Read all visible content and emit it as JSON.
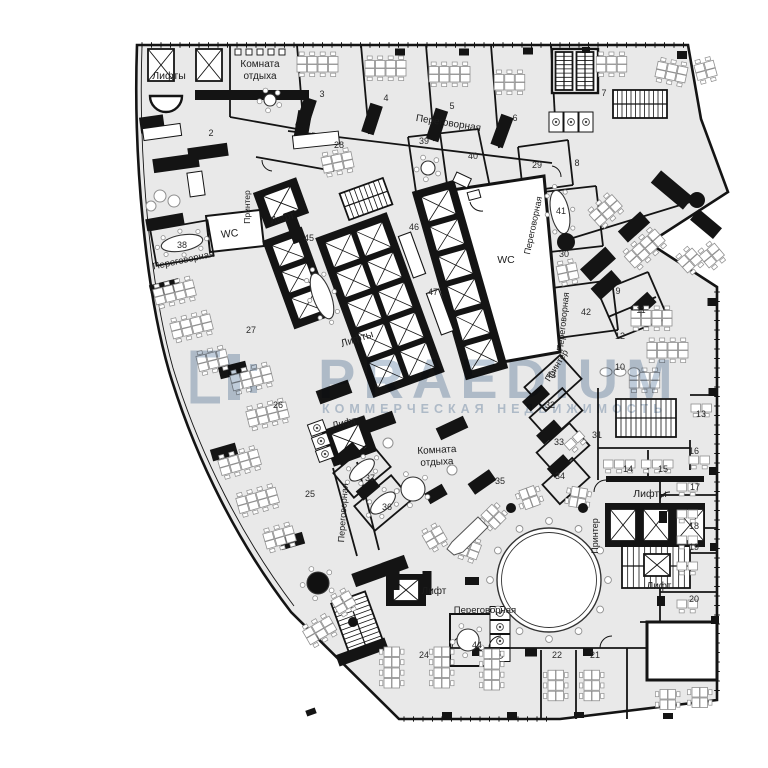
{
  "plan": {
    "labels": [
      {
        "text": "Лифты",
        "x": 169,
        "y": 79,
        "rot": 0,
        "size": 10.5
      },
      {
        "text": "Комната",
        "x": 260,
        "y": 67,
        "rot": 0,
        "size": 10
      },
      {
        "text": "отдыха",
        "x": 260,
        "y": 79,
        "rot": 0,
        "size": 10
      },
      {
        "text": "Переговорная",
        "x": 448,
        "y": 126,
        "rot": 9,
        "size": 10
      },
      {
        "text": "Принтер",
        "x": 250,
        "y": 207,
        "rot": -90,
        "size": 8.5
      },
      {
        "text": "Лифт",
        "x": 283,
        "y": 221,
        "rot": -14,
        "size": 10
      },
      {
        "text": "WC",
        "x": 230,
        "y": 237,
        "rot": -6,
        "size": 10.5
      },
      {
        "text": "Переговорная",
        "x": 184,
        "y": 263,
        "rot": -12,
        "size": 9.5
      },
      {
        "text": "Лифты",
        "x": 358,
        "y": 342,
        "rot": -18,
        "size": 10.5
      },
      {
        "text": "WC",
        "x": 506,
        "y": 263,
        "rot": 0,
        "size": 10.5
      },
      {
        "text": "Переговорная",
        "x": 536,
        "y": 226,
        "rot": -78,
        "size": 9
      },
      {
        "text": "Переговорная",
        "x": 566,
        "y": 322,
        "rot": -84,
        "size": 9
      },
      {
        "text": "Принтер",
        "x": 559,
        "y": 367,
        "rot": -58,
        "size": 9
      },
      {
        "text": "Лифт",
        "x": 345,
        "y": 426,
        "rot": -14,
        "size": 10
      },
      {
        "text": "Комната",
        "x": 437,
        "y": 453,
        "rot": -3,
        "size": 10
      },
      {
        "text": "отдыха",
        "x": 437,
        "y": 465,
        "rot": -3,
        "size": 10
      },
      {
        "text": "Переговорная",
        "x": 346,
        "y": 513,
        "rot": -86,
        "size": 9
      },
      {
        "text": "Принтер",
        "x": 598,
        "y": 536,
        "rot": -90,
        "size": 9
      },
      {
        "text": "Лифты",
        "x": 650,
        "y": 497,
        "rot": 0,
        "size": 10.5
      },
      {
        "text": "Лифт",
        "x": 659,
        "y": 589,
        "rot": 0,
        "size": 10
      },
      {
        "text": "Лифт",
        "x": 434,
        "y": 594,
        "rot": 0,
        "size": 10
      },
      {
        "text": "Переговорная",
        "x": 485,
        "y": 613,
        "rot": 0,
        "size": 9.5
      }
    ],
    "room_numbers": [
      {
        "n": "2",
        "x": 211,
        "y": 136
      },
      {
        "n": "3",
        "x": 322,
        "y": 97
      },
      {
        "n": "4",
        "x": 386,
        "y": 101
      },
      {
        "n": "5",
        "x": 452,
        "y": 109
      },
      {
        "n": "6",
        "x": 515,
        "y": 121
      },
      {
        "n": "7",
        "x": 604,
        "y": 96
      },
      {
        "n": "8",
        "x": 577,
        "y": 166
      },
      {
        "n": "9",
        "x": 618,
        "y": 294
      },
      {
        "n": "10",
        "x": 620,
        "y": 370
      },
      {
        "n": "11",
        "x": 641,
        "y": 313
      },
      {
        "n": "12",
        "x": 620,
        "y": 339
      },
      {
        "n": "13",
        "x": 701,
        "y": 417
      },
      {
        "n": "14",
        "x": 628,
        "y": 472
      },
      {
        "n": "15",
        "x": 663,
        "y": 472
      },
      {
        "n": "16",
        "x": 694,
        "y": 454
      },
      {
        "n": "17",
        "x": 695,
        "y": 490
      },
      {
        "n": "18",
        "x": 694,
        "y": 529
      },
      {
        "n": "19",
        "x": 694,
        "y": 550
      },
      {
        "n": "20",
        "x": 694,
        "y": 602
      },
      {
        "n": "21",
        "x": 595,
        "y": 658
      },
      {
        "n": "22",
        "x": 557,
        "y": 658
      },
      {
        "n": "24",
        "x": 424,
        "y": 658
      },
      {
        "n": "25",
        "x": 310,
        "y": 497
      },
      {
        "n": "26",
        "x": 278,
        "y": 408
      },
      {
        "n": "27",
        "x": 251,
        "y": 333
      },
      {
        "n": "28",
        "x": 339,
        "y": 148
      },
      {
        "n": "29",
        "x": 537,
        "y": 168
      },
      {
        "n": "30",
        "x": 564,
        "y": 257
      },
      {
        "n": "31",
        "x": 597,
        "y": 438
      },
      {
        "n": "32",
        "x": 550,
        "y": 408
      },
      {
        "n": "33",
        "x": 559,
        "y": 445
      },
      {
        "n": "34",
        "x": 560,
        "y": 479
      },
      {
        "n": "35",
        "x": 500,
        "y": 484
      },
      {
        "n": "36",
        "x": 387,
        "y": 510
      },
      {
        "n": "37",
        "x": 370,
        "y": 481
      },
      {
        "n": "38",
        "x": 182,
        "y": 248
      },
      {
        "n": "39",
        "x": 424,
        "y": 144
      },
      {
        "n": "40",
        "x": 473,
        "y": 159
      },
      {
        "n": "41",
        "x": 561,
        "y": 214
      },
      {
        "n": "42",
        "x": 586,
        "y": 315
      },
      {
        "n": "43",
        "x": 551,
        "y": 378
      },
      {
        "n": "44",
        "x": 477,
        "y": 648
      },
      {
        "n": "45",
        "x": 309,
        "y": 241
      },
      {
        "n": "46",
        "x": 414,
        "y": 230
      },
      {
        "n": "47",
        "x": 433,
        "y": 295
      }
    ]
  },
  "watermark": {
    "brand": "PRAEDIUM",
    "subtitle": "КОММЕРЧЕСКАЯ НЕДВИЖИМОСТЬ",
    "color": "#b4c3d4"
  },
  "colors": {
    "floor": "#e9e9e9",
    "wall": "#141414",
    "furniture": "#8f8f8f",
    "label": "#1c1c1c"
  }
}
